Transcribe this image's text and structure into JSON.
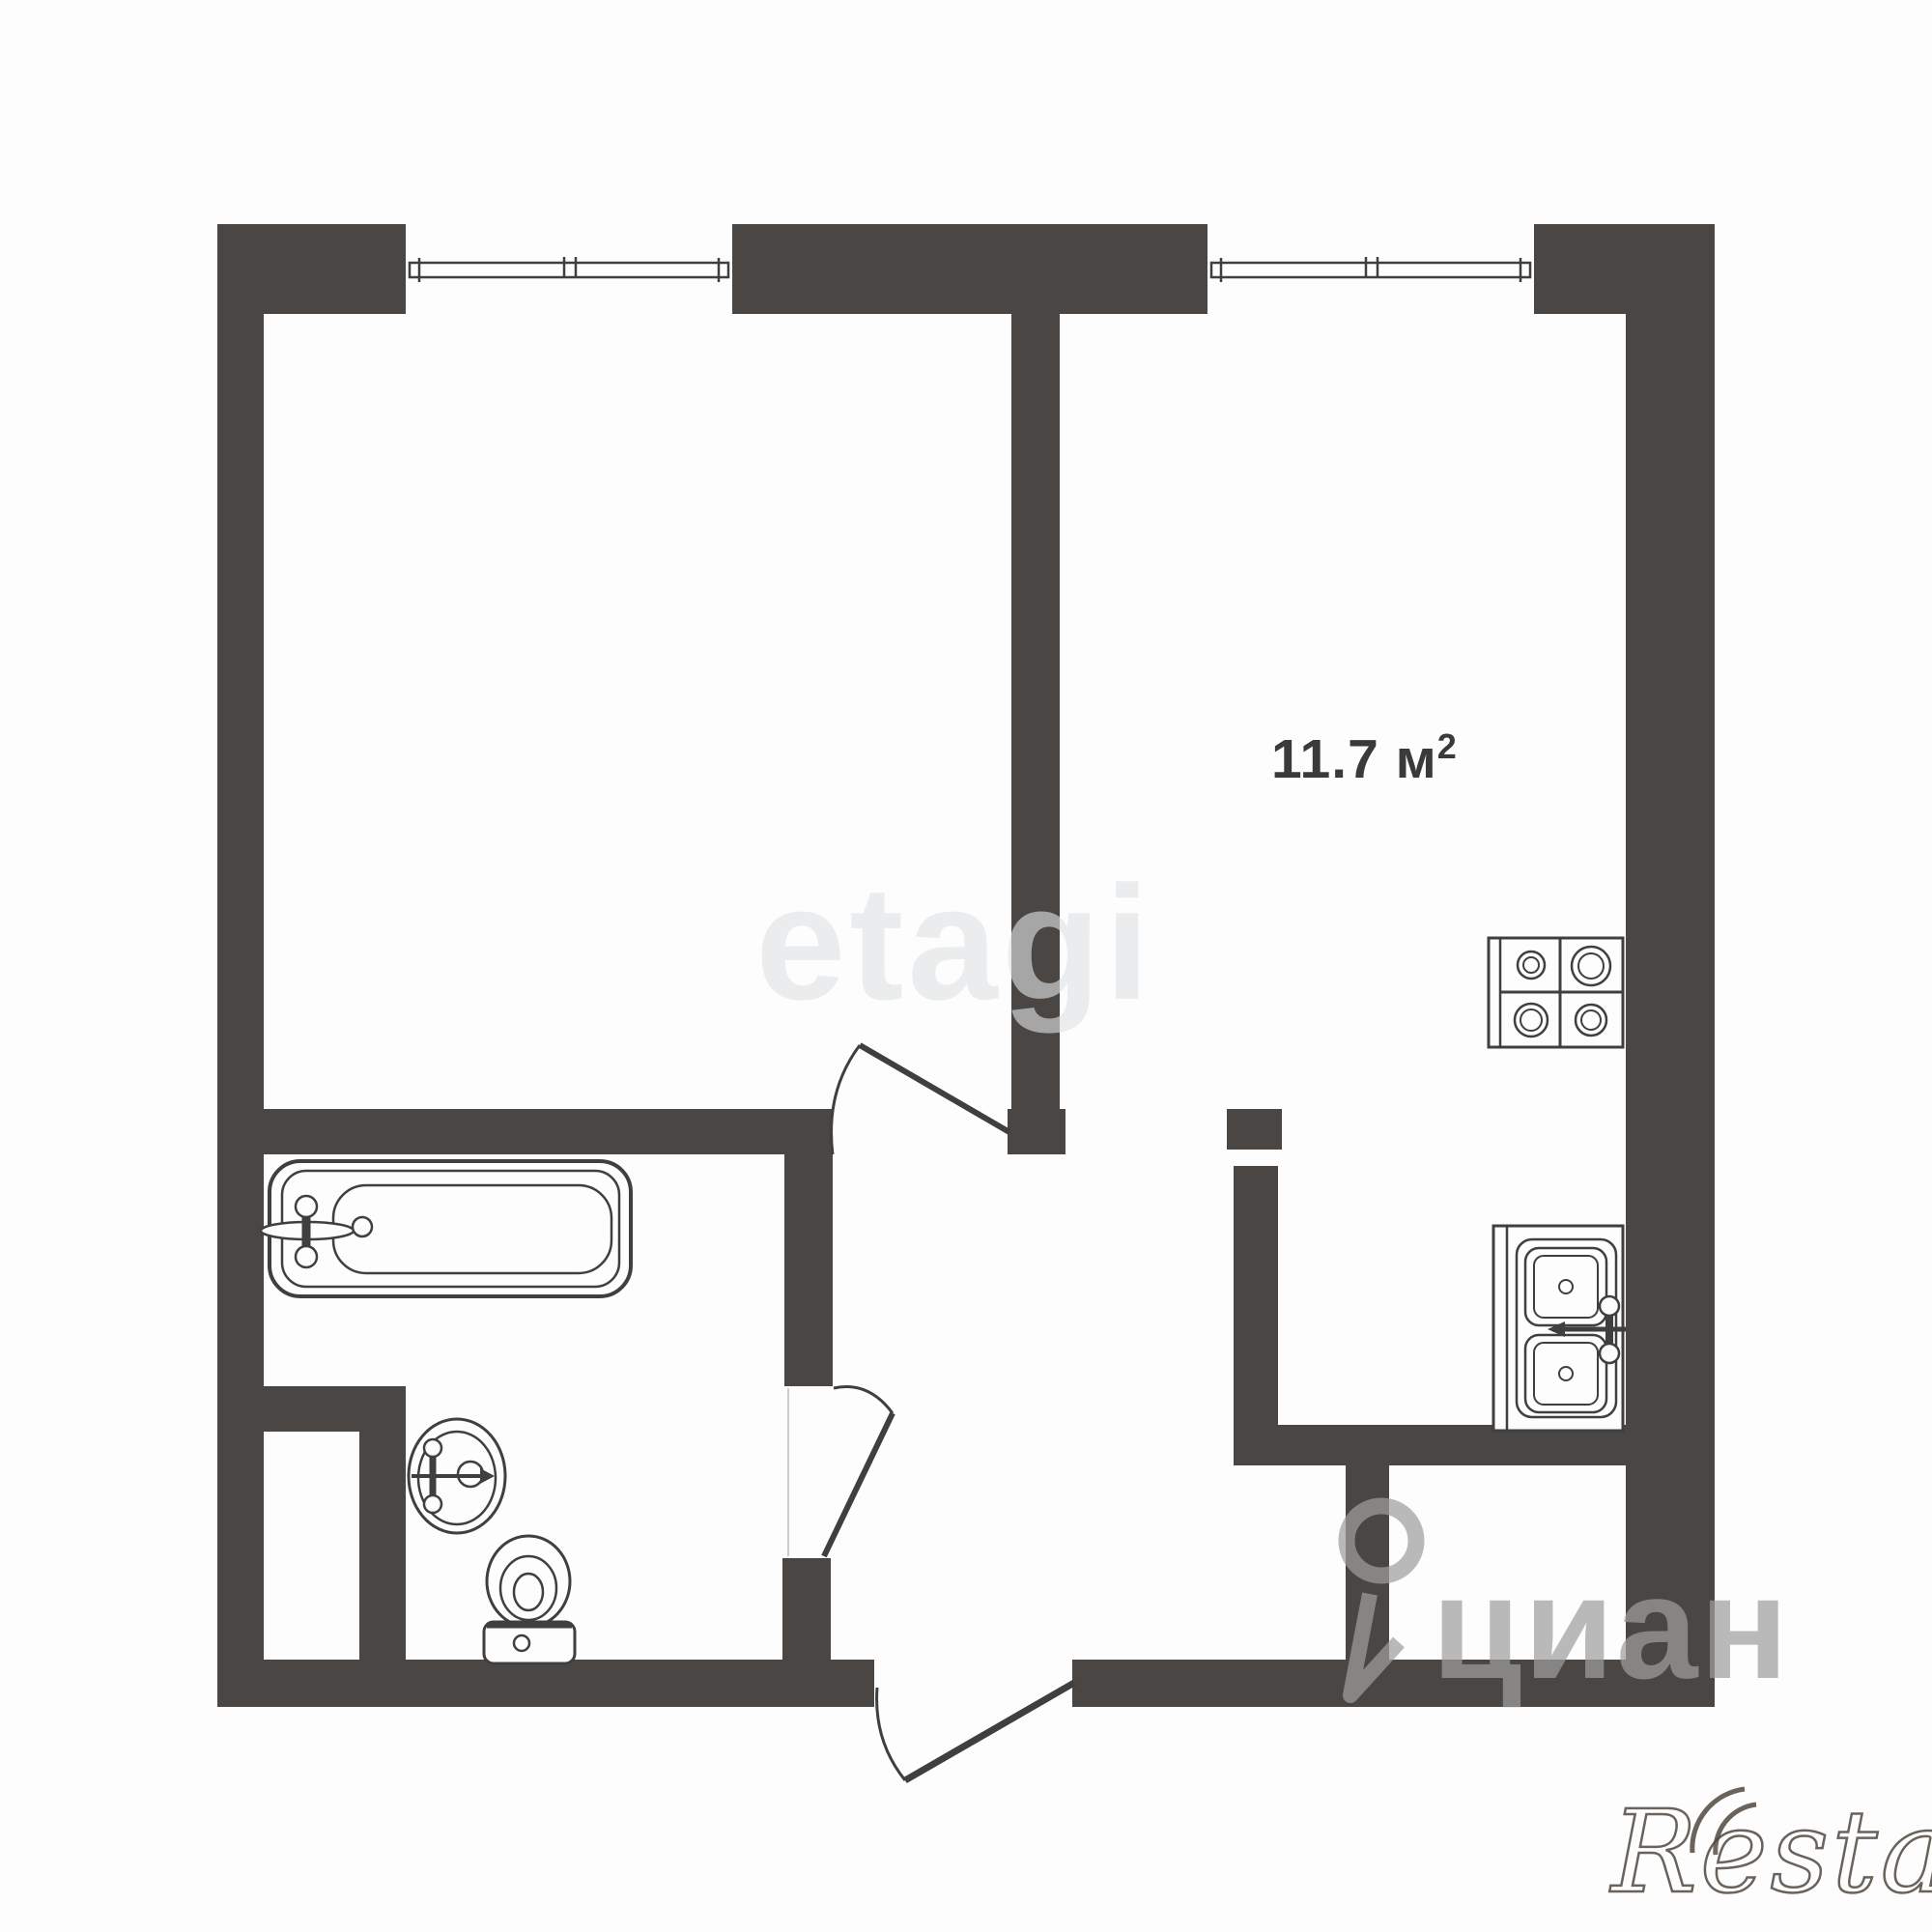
{
  "plan": {
    "type": "apartment-floor-plan",
    "area_label": {
      "text": "11.7 м",
      "sup": "2"
    }
  },
  "watermarks": {
    "etagi": "etagi",
    "cian": "циан",
    "restate": "Restate"
  },
  "fixtures": [
    "window",
    "window",
    "bathtub",
    "washbasin",
    "toilet",
    "stove",
    "kitchen-sink",
    "interior-door",
    "bathroom-door",
    "entrance-door"
  ],
  "colors": {
    "wall": "#4a4643",
    "fixture_line": "#3f3f3f",
    "label_text": "#3a3a3a",
    "watermark_etagi": "#e4e7e8",
    "watermark_cian": "#9e9e9e",
    "watermark_restate": "#50483f"
  }
}
